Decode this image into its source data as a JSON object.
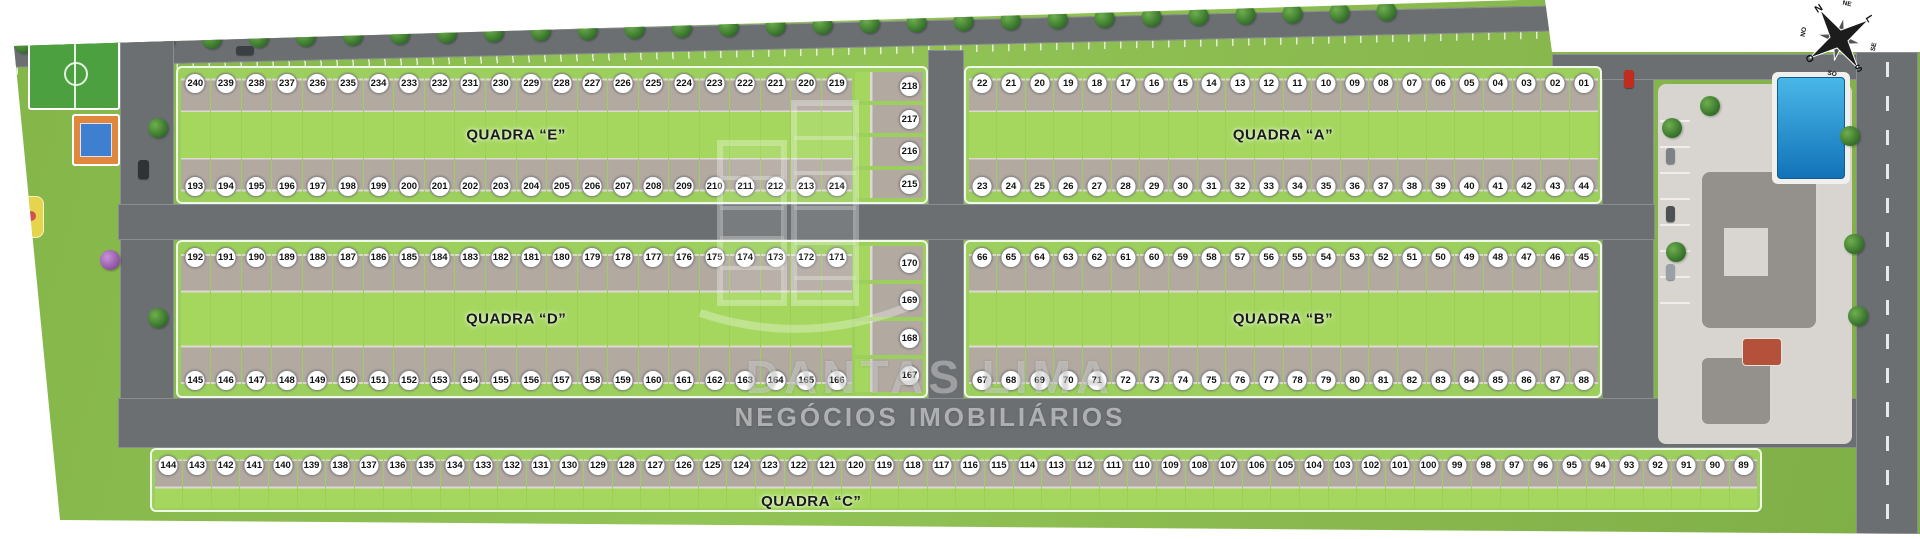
{
  "plan_title": "Loteamento - implantação",
  "colors": {
    "grass": "#86b64b",
    "grass_light": "#9ccf5d",
    "yard": "#a5d75f",
    "road": "#6b6f72",
    "roof": "#b2a9a1",
    "sidewalk": "#e9e7e3",
    "pool_light": "#49b7e8",
    "pool_dark": "#1273b8",
    "field_green": "#4da03f",
    "court_orange": "#e0873c",
    "court_blue": "#3f7fd0",
    "sand_yellow": "#e6d44c",
    "building_gray": "#94908c",
    "red_roof": "#b5513a"
  },
  "watermark": {
    "name": "DANTAS LIMA",
    "subtitle": "NEGÓCIOS IMOBILIÁRIOS",
    "logo": "building-logo-icon"
  },
  "compass": {
    "icon": "compass-rose-icon",
    "points": {
      "n": "N",
      "ne": "NE",
      "e": "L",
      "se": "SE",
      "s": "S",
      "so": "SO",
      "o": "O",
      "no": "NO"
    }
  },
  "amenities": {
    "soccer_field": "soccer-field",
    "sports_court": "sports-court",
    "playground": "playground",
    "clubhouse": "clubhouse",
    "pool": "swimming-pool",
    "parking": "parking-row"
  },
  "quadras": [
    {
      "id": "E",
      "label": "QUADRA “E”",
      "top_row": [
        "240",
        "239",
        "238",
        "237",
        "236",
        "235",
        "234",
        "233",
        "232",
        "231",
        "230",
        "229",
        "228",
        "227",
        "226",
        "225",
        "224",
        "223",
        "222",
        "221",
        "220",
        "219"
      ],
      "right_col": [
        "218",
        "217",
        "216",
        "215"
      ],
      "bottom_row": [
        "193",
        "194",
        "195",
        "196",
        "197",
        "198",
        "199",
        "200",
        "201",
        "202",
        "203",
        "204",
        "205",
        "206",
        "207",
        "208",
        "209",
        "210",
        "211",
        "212",
        "213",
        "214"
      ]
    },
    {
      "id": "A",
      "label": "QUADRA “A”",
      "top_row": [
        "22",
        "21",
        "20",
        "19",
        "18",
        "17",
        "16",
        "15",
        "14",
        "13",
        "12",
        "11",
        "10",
        "09",
        "08",
        "07",
        "06",
        "05",
        "04",
        "03",
        "02",
        "01"
      ],
      "bottom_row": [
        "23",
        "24",
        "25",
        "26",
        "27",
        "28",
        "29",
        "30",
        "31",
        "32",
        "33",
        "34",
        "35",
        "36",
        "37",
        "38",
        "39",
        "40",
        "41",
        "42",
        "43",
        "44"
      ]
    },
    {
      "id": "D",
      "label": "QUADRA “D”",
      "top_row": [
        "192",
        "191",
        "190",
        "189",
        "188",
        "187",
        "186",
        "185",
        "184",
        "183",
        "182",
        "181",
        "180",
        "179",
        "178",
        "177",
        "176",
        "175",
        "174",
        "173",
        "172",
        "171"
      ],
      "right_col": [
        "170",
        "169",
        "168",
        "167"
      ],
      "bottom_row": [
        "145",
        "146",
        "147",
        "148",
        "149",
        "150",
        "151",
        "152",
        "153",
        "154",
        "155",
        "156",
        "157",
        "158",
        "159",
        "160",
        "161",
        "162",
        "163",
        "164",
        "165",
        "166"
      ]
    },
    {
      "id": "B",
      "label": "QUADRA “B”",
      "top_row": [
        "66",
        "65",
        "64",
        "63",
        "62",
        "61",
        "60",
        "59",
        "58",
        "57",
        "56",
        "55",
        "54",
        "53",
        "52",
        "51",
        "50",
        "49",
        "48",
        "47",
        "46",
        "45"
      ],
      "bottom_row": [
        "67",
        "68",
        "69",
        "70",
        "71",
        "72",
        "73",
        "74",
        "75",
        "76",
        "77",
        "78",
        "79",
        "80",
        "81",
        "82",
        "83",
        "84",
        "85",
        "86",
        "87",
        "88"
      ]
    },
    {
      "id": "C",
      "label": "QUADRA “C”",
      "single_row": [
        "144",
        "143",
        "142",
        "141",
        "140",
        "139",
        "138",
        "137",
        "136",
        "135",
        "134",
        "133",
        "132",
        "131",
        "130",
        "129",
        "128",
        "127",
        "126",
        "125",
        "124",
        "123",
        "122",
        "121",
        "120",
        "119",
        "118",
        "117",
        "116",
        "115",
        "114",
        "113",
        "112",
        "111",
        "110",
        "109",
        "108",
        "107",
        "106",
        "105",
        "104",
        "103",
        "102",
        "101",
        "100",
        "99",
        "98",
        "97",
        "96",
        "95",
        "94",
        "93",
        "92",
        "91",
        "90",
        "89"
      ]
    }
  ]
}
